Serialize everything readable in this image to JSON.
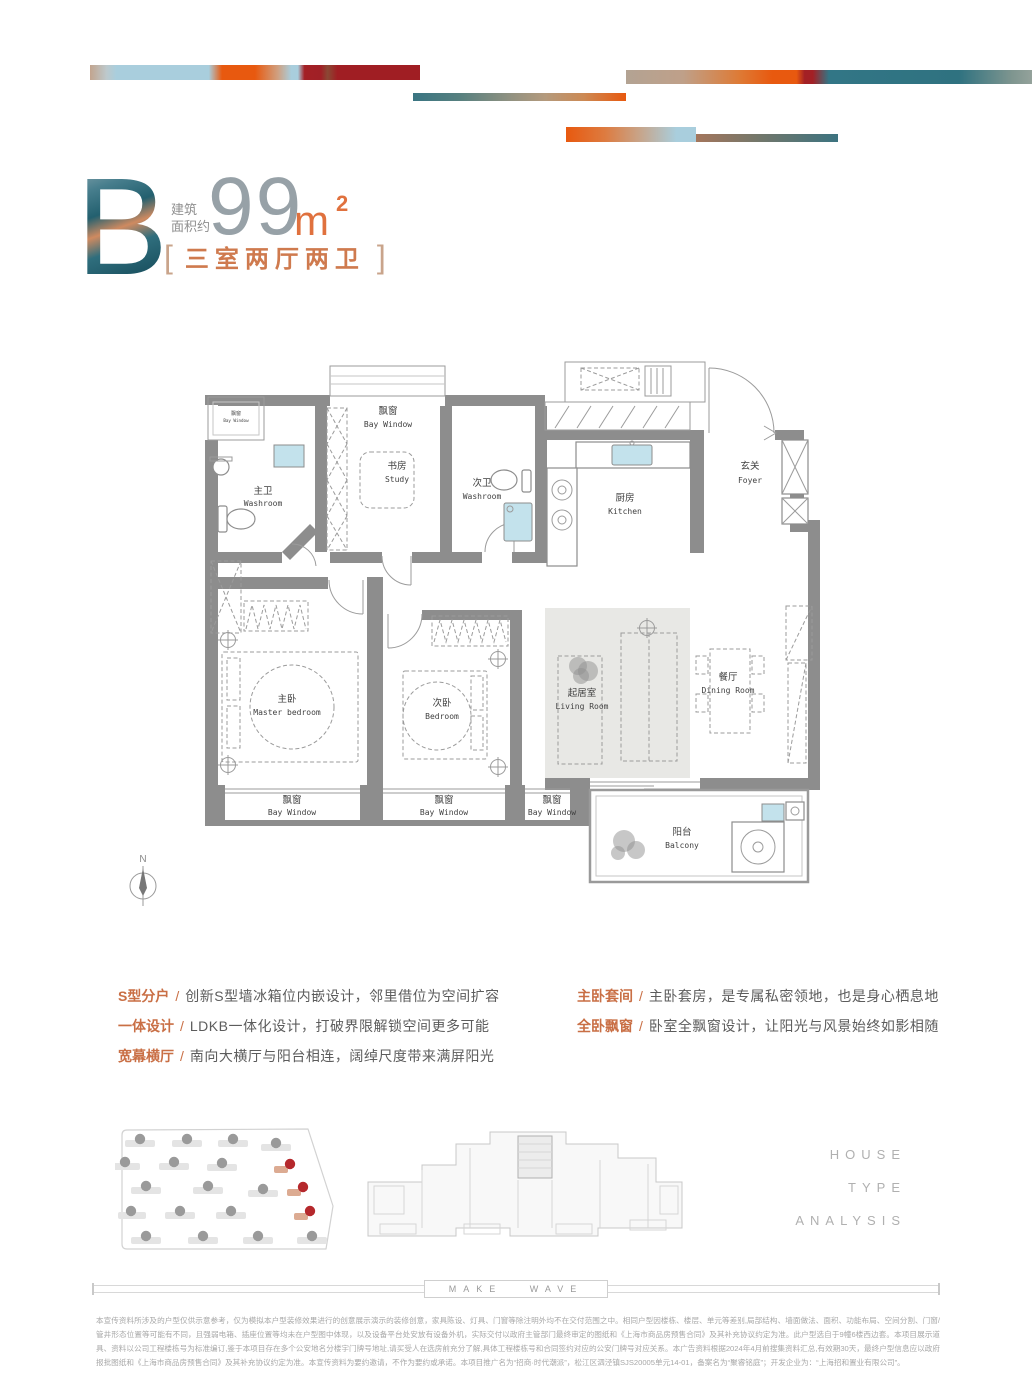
{
  "header": {
    "unit": "B",
    "area_label_line1": "建筑",
    "area_label_line2": "面积约",
    "area_value": "99",
    "area_unit": "m",
    "area_unit_sup": "2",
    "bracket_left": "[",
    "bracket_right": "]",
    "layout_text": "三室两厅两卫"
  },
  "floorplan": {
    "compass_label": "N",
    "rooms": {
      "bay_small": {
        "cn": "飘窗",
        "en": "Bay Window"
      },
      "master_bath": {
        "cn": "主卫",
        "en": "Washroom"
      },
      "bay_top": {
        "cn": "飘窗",
        "en": "Bay Window"
      },
      "study": {
        "cn": "书房",
        "en": "Study"
      },
      "second_bath": {
        "cn": "次卫",
        "en": "Washroom"
      },
      "kitchen": {
        "cn": "厨房",
        "en": "Kitchen"
      },
      "foyer": {
        "cn": "玄关",
        "en": "Foyer"
      },
      "master_bedroom": {
        "cn": "主卧",
        "en": "Master bedroom"
      },
      "bedroom": {
        "cn": "次卧",
        "en": "Bedroom"
      },
      "living": {
        "cn": "起居室",
        "en": "Living Room"
      },
      "dining": {
        "cn": "餐厅",
        "en": "Dining Room"
      },
      "balcony": {
        "cn": "阳台",
        "en": "Balcony"
      },
      "bay_b1": {
        "cn": "飘窗",
        "en": "Bay Window"
      },
      "bay_b2": {
        "cn": "飘窗",
        "en": "Bay Window"
      },
      "bay_b3": {
        "cn": "飘窗",
        "en": "Bay Window"
      }
    }
  },
  "features": {
    "left": [
      {
        "label": "S型分户",
        "sep": "/",
        "desc": "创新S型墙冰箱位内嵌设计，邻里借位为空间扩容"
      },
      {
        "label": "一体设计",
        "sep": "/",
        "desc": "LDKB一体化设计，打破界限解锁空间更多可能"
      },
      {
        "label": "宽幕横厅",
        "sep": "/",
        "desc": "南向大横厅与阳台相连，阔绰尺度带来满屏阳光"
      }
    ],
    "right": [
      {
        "label": "主卧套间",
        "sep": "/",
        "desc": "主卧套房，是专属私密领地，也是身心栖息地"
      },
      {
        "label": "全卧飘窗",
        "sep": "/",
        "desc": "卧室全飘窗设计，让阳光与风景始终如影相随"
      }
    ]
  },
  "footer": {
    "house_type_lines": [
      "HOUSE",
      "TYPE",
      "ANALYSIS"
    ],
    "make_wave": "MAKE WAVE",
    "disclaimer_lines": [
      "本宣传资料所涉及的户型仅供示意参考，仅为模拟本户型装修效果进行的创意展示演示的装修创意，家具陈设、灯具、门窗等除注明外均不在交付范围之中。相同户型因楼栋、楼层、单元等差别,局部结构、墙面做法、面积、功能布局、空间分割、门窗/管井形态位置等可能有不同，且强弱电箱、插座位置等均未在户型图中体现，以",
      "及设备平台处安放有设备外机，实际交付以政府主管部门最终审定的图纸和《上海市商品房预售合同》及其补充协议约定为准。此户型选自于9幢6楼西边套。本项目展示道具、资料以公司工程楼栋号为标准编订,鉴于本项目存在多个公安地名分楼宇门牌号地址,请买受人在选房前充分了解,具体工程楼栋号和合同签约对应的公安",
      "门牌号对应关系。本广告资料根据2024年4月前搜集资料汇总,有效期30天，最终户型信息应以政府报批图纸和《上海市商品房预售合同》及其补充协议约定为准。本宣传资料为要约邀请，不作为要约或承诺。本项目推广名为“招商·时代潮派”，松江区泗泾镇SJS20005单元14-01，备案名为“聚睿铭庭”；开发企业为：“上海招",
      "和置业有限公司”。"
    ]
  },
  "colors": {
    "accent_orange": "#e8590f",
    "accent_red": "#a01e23",
    "accent_teal": "#2f7280",
    "accent_lightblue": "#a9cedd",
    "feature_label": "#c96f45",
    "wall_grey": "#8d8d8d"
  }
}
